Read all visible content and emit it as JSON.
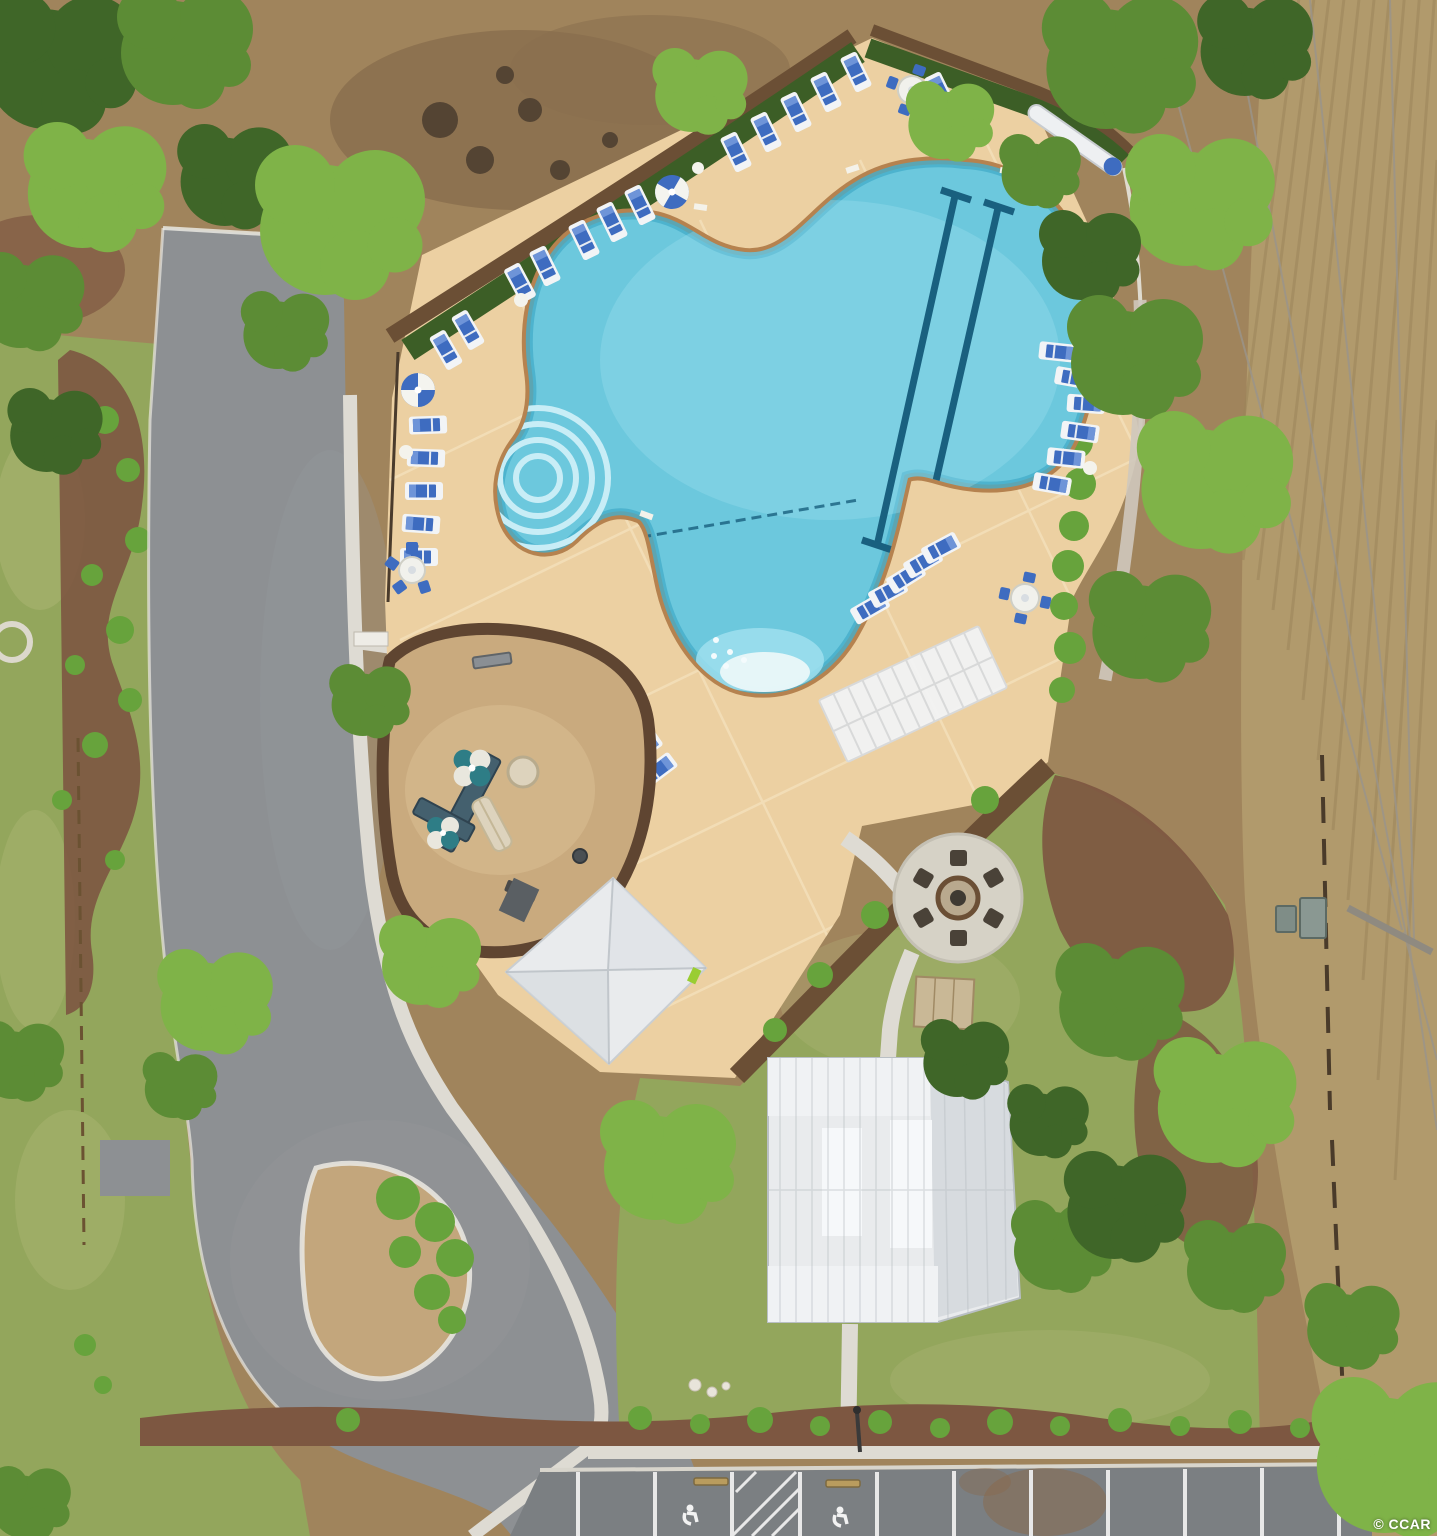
{
  "meta": {
    "watermark": "© CCAR",
    "description": "Aerial drone view of a community amenity center: free-form swimming pool with tan deck and blue loungers, playground, gazebo, clubhouse with white metal roof, fire pit circle, cul-de-sac road and parking with handicap spaces."
  },
  "scene": {
    "features": [
      "free-form-pool",
      "lap-lanes",
      "pool-steps",
      "beach-entry",
      "pool-deck",
      "lounge-chairs",
      "umbrella-tables",
      "shade-pergola",
      "playground",
      "gazebo",
      "clubhouse",
      "fire-pit",
      "cul-de-sac",
      "parking-lot",
      "handicap-spaces",
      "sidewalks",
      "hedges",
      "trees",
      "open-field",
      "utility-boxes",
      "power-lines"
    ],
    "counts": {
      "lounge_chairs": 35,
      "umbrella_tables": 6,
      "fire_pit_chairs": 6,
      "lap_lanes": 2,
      "handicap_symbols": 2
    }
  },
  "colors": {
    "base_dirt": "#a0845c",
    "field_tan": "#b19a6c",
    "grass": "#93a65c",
    "grass_light": "#b9bc7e",
    "road_gray": "#8d9093",
    "parking_gray": "#7b7f82",
    "sidewalk": "#dedbd3",
    "curb": "#e9e7e0",
    "deck_tan": "#ecd0a2",
    "deck_joint": "#f6e4c2",
    "coping": "#b5824f",
    "pool_water": "#6cc8dd",
    "pool_deep": "#46aecb",
    "pool_light": "#9fdfee",
    "steps_light": "#c8edf6",
    "lane_navy": "#19607f",
    "lounger_blue": "#3e6cc0",
    "lounger_frame": "#f2f4f6",
    "umbrella_white": "#f1f1ec",
    "hedge": "#3c5e26",
    "mulch_dark": "#6b4f35",
    "mulch_red": "#7d5741",
    "pebble": "#c9aa7e",
    "pebble_border": "#5f4531",
    "roof_white": "#e9ebed",
    "roof_shade": "#d7dbdf",
    "patio_gray": "#d6d2c6",
    "chair_dark": "#4a4238",
    "island_dirt": "#c3a67c",
    "shrub": "#67a33c",
    "tree_dark": "#3f6628",
    "tree_mid": "#5c8c35",
    "tree_light": "#7fb348",
    "brush": "#8a6f4e",
    "equip_teal": "#2e7d86",
    "slide_beige": "#ddd3bd",
    "stone_tan": "#c9b896",
    "wheelstop": "#b99c5e",
    "stain": "#8a6a4a"
  }
}
